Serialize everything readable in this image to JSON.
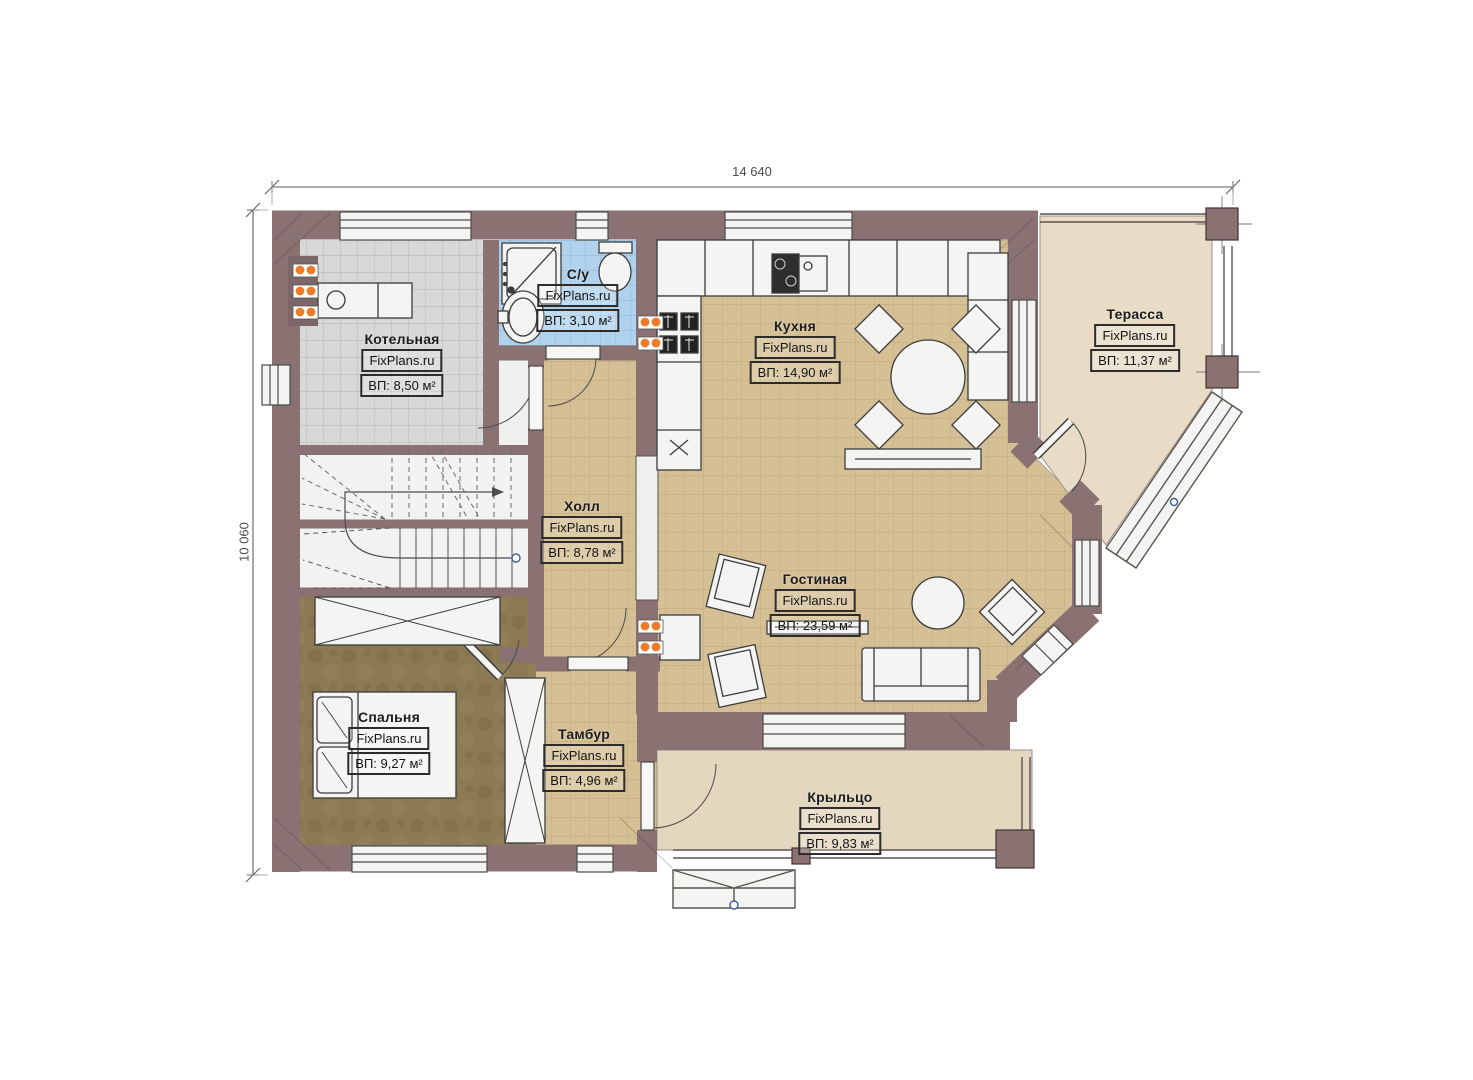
{
  "plan_type": "floor-plan",
  "dimensions": {
    "width_label": "14 640",
    "height_label": "10 060"
  },
  "brand": "FixPlans.ru",
  "rooms": [
    {
      "name": "Котельная",
      "brand": "FixPlans.ru",
      "area": "ВП: 8,50 м²"
    },
    {
      "name": "С/у",
      "brand": "FixPlans.ru",
      "area": "ВП: 3,10 м²"
    },
    {
      "name": "Кухня",
      "brand": "FixPlans.ru",
      "area": "ВП: 14,90 м²"
    },
    {
      "name": "Терасса",
      "brand": "FixPlans.ru",
      "area": "ВП: 11,37 м²"
    },
    {
      "name": "Холл",
      "brand": "FixPlans.ru",
      "area": "ВП: 8,78 м²"
    },
    {
      "name": "Гостиная",
      "brand": "FixPlans.ru",
      "area": "ВП: 23,59 м²"
    },
    {
      "name": "Спальня",
      "brand": "FixPlans.ru",
      "area": "ВП: 9,27 м²"
    },
    {
      "name": "Тамбур",
      "brand": "FixPlans.ru",
      "area": "ВП: 4,96 м²"
    },
    {
      "name": "Крыльцо",
      "brand": "FixPlans.ru",
      "area": "ВП: 9,83 м²"
    }
  ],
  "colors": {
    "wall": "#8a7172",
    "floor_tile": "#d5bf94",
    "bathroom_tile": "#b0d2ec",
    "boiler_tile": "#d8d8d6",
    "bedroom_floor": "#8c7a54",
    "outdoor_floor": "#e8dcc6",
    "radiator": "#ef7b28"
  }
}
